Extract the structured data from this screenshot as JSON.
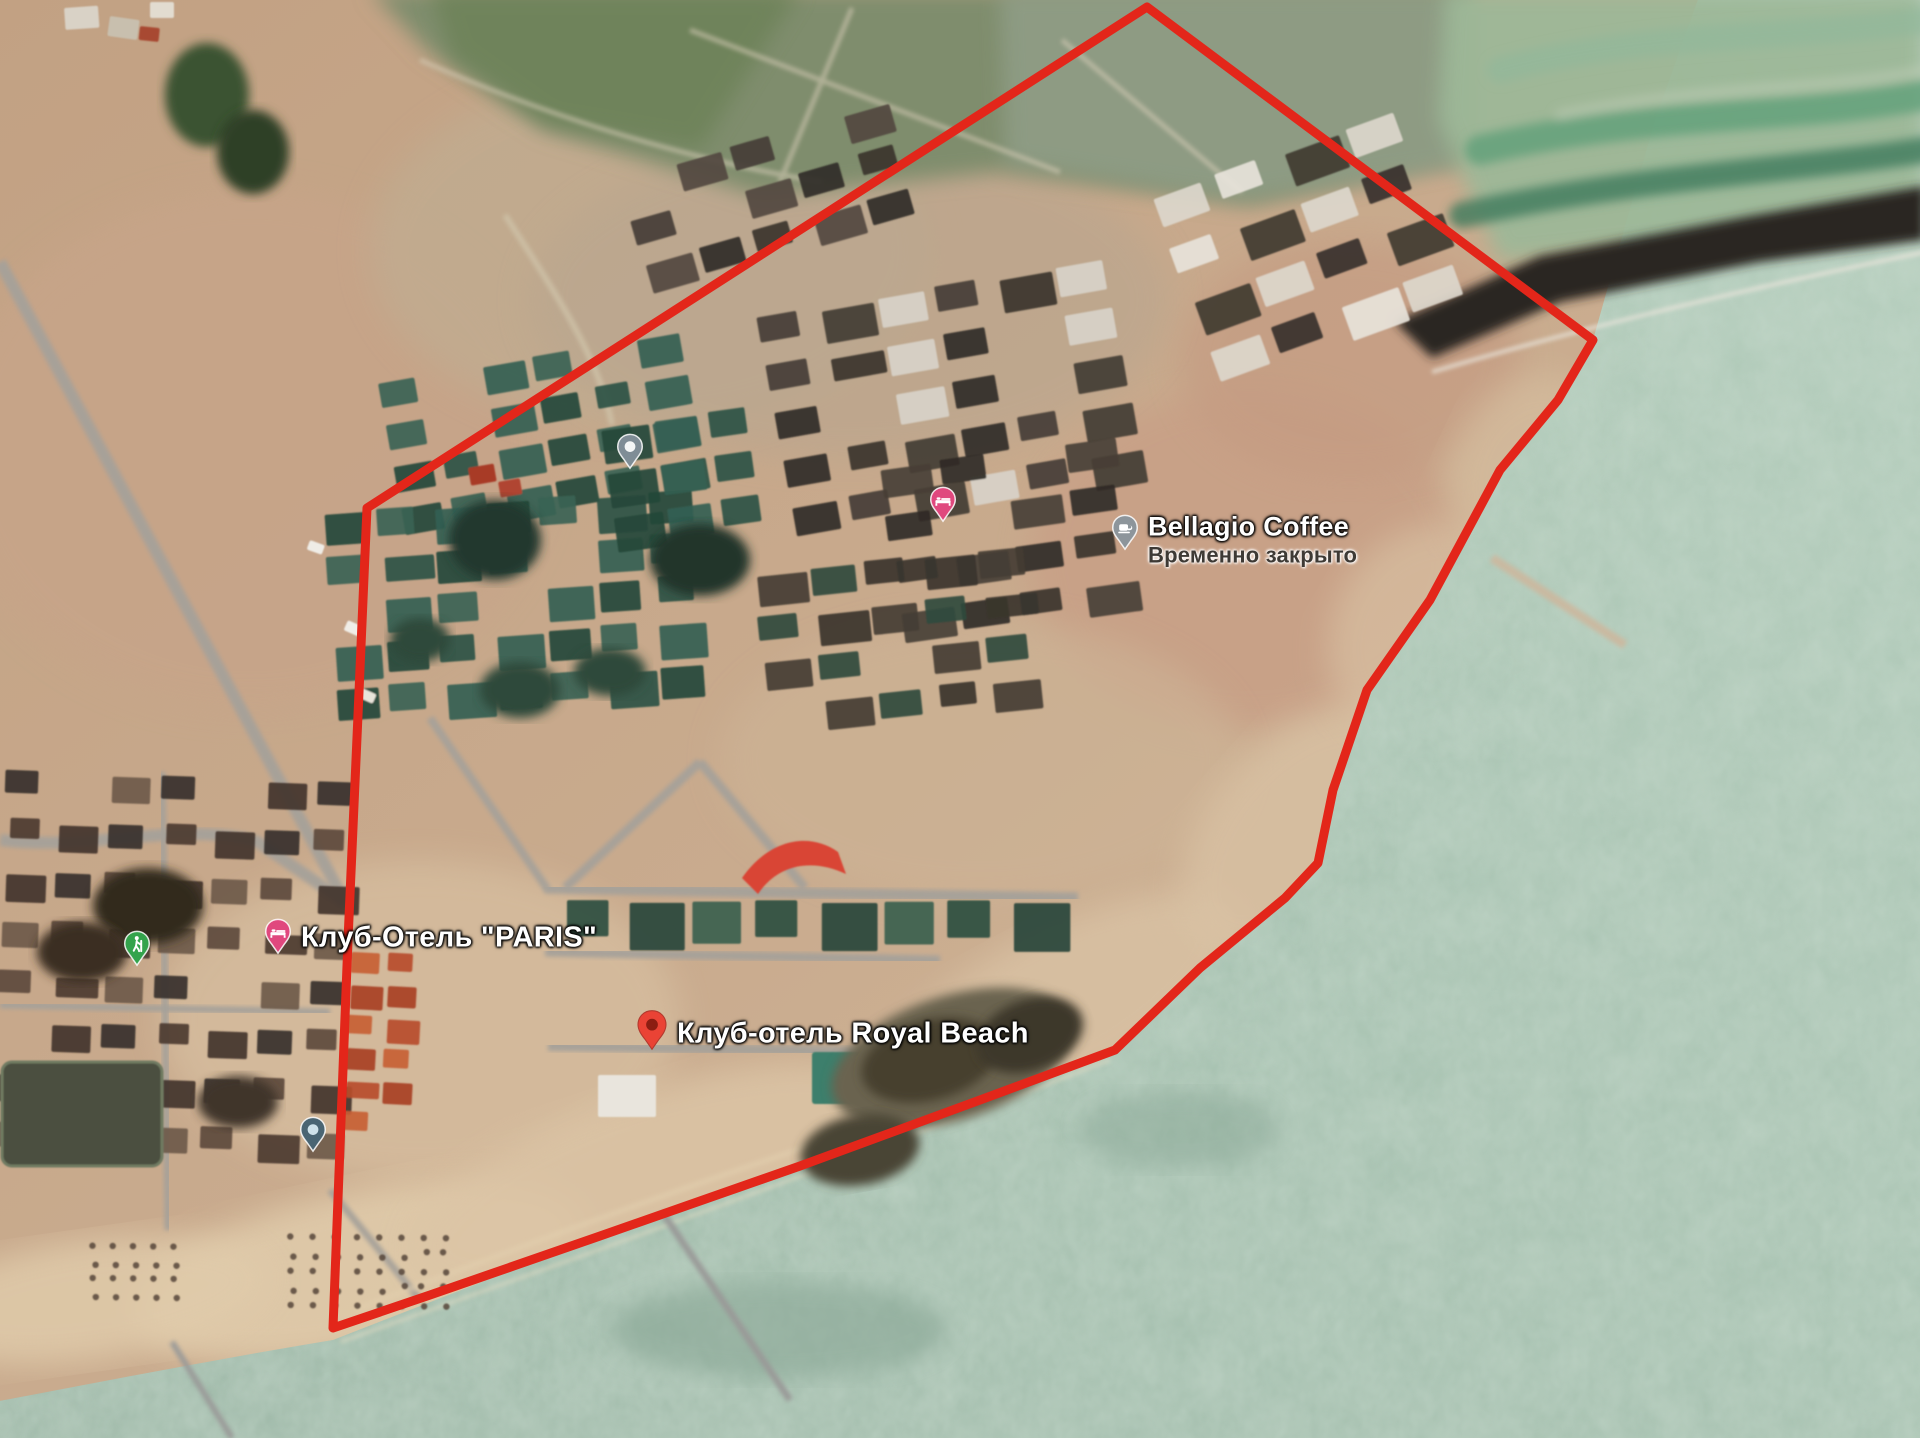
{
  "map": {
    "type": "satellite",
    "location_hint": "Issyk-Kul lakeside resort area",
    "boundary": {
      "color": "#e3261a",
      "stroke_width": 9,
      "points": [
        [
          1147,
          7
        ],
        [
          1593,
          340
        ],
        [
          1558,
          400
        ],
        [
          1500,
          470
        ],
        [
          1430,
          600
        ],
        [
          1367,
          690
        ],
        [
          1333,
          790
        ],
        [
          1318,
          863
        ],
        [
          1285,
          898
        ],
        [
          1200,
          968
        ],
        [
          1115,
          1050
        ],
        [
          980,
          1100
        ],
        [
          800,
          1166
        ],
        [
          600,
          1236
        ],
        [
          430,
          1295
        ],
        [
          333,
          1328
        ],
        [
          348,
          940
        ],
        [
          358,
          715
        ],
        [
          367,
          508
        ]
      ]
    },
    "pois": [
      {
        "id": "parizh-2",
        "name": "Париж-2",
        "pin": "place-gray",
        "pin_color": "#7f8d96",
        "x": 630,
        "y": 447,
        "text_side": "left",
        "font_size": 29,
        "text_color": "#ffffff",
        "label_dy": 2
      },
      {
        "id": "palm-beach-hotel",
        "name": "Клуб отель Палм Бич Иссык Куль",
        "lines": [
          "Клуб отель Палм",
          "Бич Иссык Куль"
        ],
        "pin": "hotel-pink",
        "pin_color": "#e0487e",
        "x": 943,
        "y": 500,
        "text_side": "left",
        "font_size": 29,
        "text_color": "#ffffff",
        "label_dy": 5
      },
      {
        "id": "bellagio-coffee",
        "name": "Bellagio Coffee",
        "status": "Временно закрыто",
        "pin": "coffee-gray",
        "pin_color": "#8d959b",
        "x": 1125,
        "y": 528,
        "text_side": "right",
        "font_size": 27,
        "text_color": "#ffffff",
        "label_dy": 12
      },
      {
        "id": "sektor-c20",
        "name": "ектор C20",
        "pin": "walker-green",
        "pin_color": "#34a34c",
        "x": 137,
        "y": 944,
        "text_side": "left",
        "font_size": 29,
        "text_color": "#3e9644",
        "halo": "light",
        "label_dy": 2
      },
      {
        "id": "klub-otel-paris",
        "name": "Клуб-Отель \"PARIS\"",
        "pin": "hotel-pink",
        "pin_color": "#e0487e",
        "x": 278,
        "y": 932,
        "text_side": "right",
        "font_size": 29,
        "text_color": "#ffffff",
        "label_dy": 6
      },
      {
        "id": "royal-beach",
        "name": "Клуб-отель Royal Beach",
        "pin": "marker-red",
        "pin_color": "#ea4335",
        "x": 652,
        "y": 1025,
        "text_side": "right",
        "font_size": 29,
        "text_color": "#ffffff",
        "label_dy": 9
      },
      {
        "id": "parizh",
        "name": "Париж",
        "pin": "place-blue",
        "pin_color": "#4a6573",
        "x": 313,
        "y": 1130,
        "text_side": "left",
        "font_size": 29,
        "text_color": "#ffffff",
        "label_dy": 8
      }
    ]
  }
}
